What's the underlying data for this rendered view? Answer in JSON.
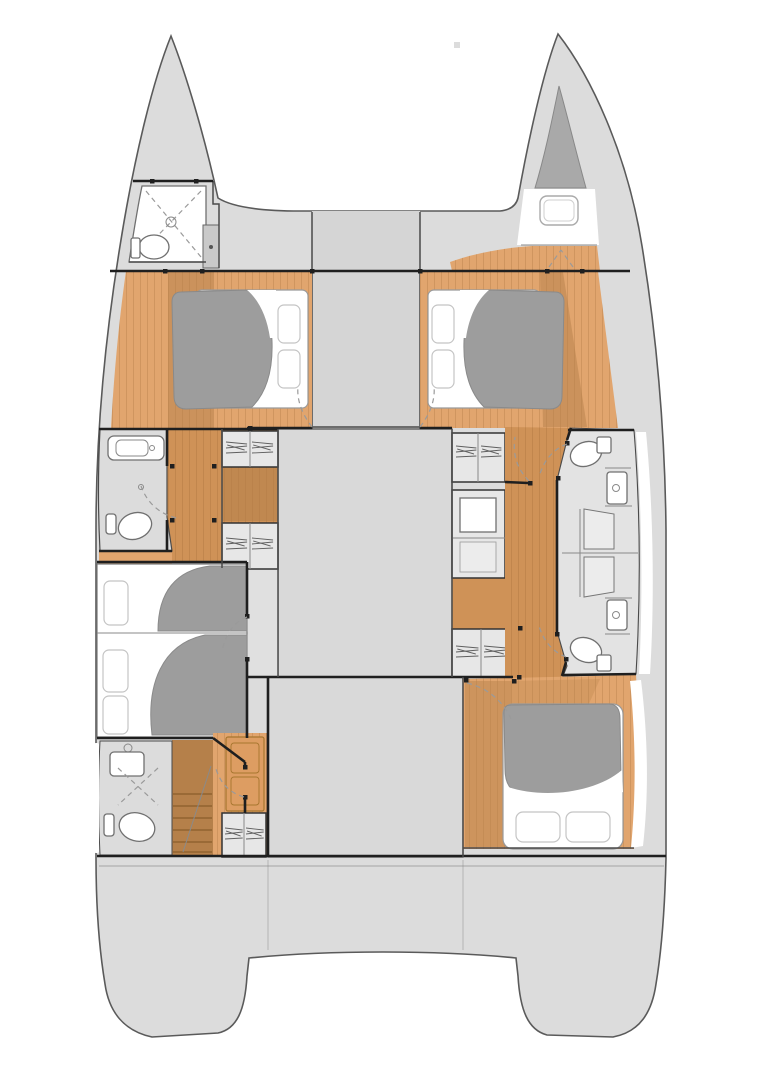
{
  "meta": {
    "type": "catamaran-interior-floor-plan",
    "view": "overhead deck plan",
    "canvas_width": 772,
    "canvas_height": 1080,
    "background": "#ffffff",
    "visible_text": ""
  },
  "colors": {
    "hull_fill": "#dcdcdc",
    "hull_line": "#5a5a5a",
    "interior_gray": "#d9d9d9",
    "heads_floor": "#e3e3e3",
    "column_fill": "#d5d5d5",
    "strip_gray": "#e0e0e0",
    "wall": "#1f1f1f",
    "partition": "#4a4a4a",
    "thin_line": "#8a8a8a",
    "wood_light": "#e1a56e",
    "wood_mid": "#cf9257",
    "wood_dark": "#b5804a",
    "plank_line": "#8a5a28",
    "mattress": "#ffffff",
    "mattress_line": "#9a9a9a",
    "duvet": "#9d9d9d",
    "duvet_line": "#8a8a8a",
    "pillow_line": "#c4c4c4",
    "fixture_fill": "#ffffff",
    "fixture_line": "#707070",
    "cabinet_fill": "#e7e7e7",
    "cabinet_line": "#333333",
    "hatch_line": "#5f5f5f",
    "shower_fill": "#d3d3d3",
    "locker_fill": "#a9a9a9",
    "door_dash": "#9a9a9a",
    "white_trim": "#ffffff",
    "stair_tread": "#8a5c2b",
    "accent_cabinet": "#dd9d62",
    "accent_cabinet_line": "#a7762f"
  },
  "vessel": {
    "kind": "sailing catamaran",
    "hulls": 2,
    "decks_shown": 1,
    "berths_drawn": 5,
    "toilets_drawn": 5,
    "sinks_drawn": 4,
    "showers_drawn": 4,
    "drawer_units_drawn": 5
  },
  "rooms": [
    {
      "id": "port-bow-head",
      "hull": "port",
      "label": "bow shower room with toilet"
    },
    {
      "id": "starboard-bow-locker",
      "hull": "starboard",
      "label": "bow anchor/storage locker with hatch"
    },
    {
      "id": "foredeck",
      "hull": "center",
      "label": "foredeck bridge with central walkway"
    },
    {
      "id": "port-forward-cabin",
      "hull": "port",
      "label": "forward double cabin with made-up berth"
    },
    {
      "id": "starboard-forward-cabin",
      "hull": "starboard",
      "label": "forward double cabin with made-up berth"
    },
    {
      "id": "saloon-block",
      "hull": "center",
      "label": "main saloon block flanked by drawer cabinets"
    },
    {
      "id": "port-forward-bathroom",
      "hull": "port",
      "label": "bathroom with sink and toilet"
    },
    {
      "id": "port-midship-cabin",
      "hull": "port",
      "label": "midship cabin with two berths"
    },
    {
      "id": "port-aft-bathroom",
      "hull": "port",
      "label": "aft bathroom with sink, shower and toilet"
    },
    {
      "id": "port-companionway",
      "hull": "port",
      "label": "companionway stairs and dresser"
    },
    {
      "id": "starboard-bathrooms",
      "hull": "starboard",
      "label": "two bathrooms with central shower benches"
    },
    {
      "id": "cockpit-block",
      "hull": "center",
      "label": "aft deck saloon / cockpit block"
    },
    {
      "id": "starboard-aft-cabin",
      "hull": "starboard",
      "label": "aft double cabin with made-up berth"
    },
    {
      "id": "aft-platform",
      "hull": "center",
      "label": "aft platform with twin transom steps"
    }
  ]
}
